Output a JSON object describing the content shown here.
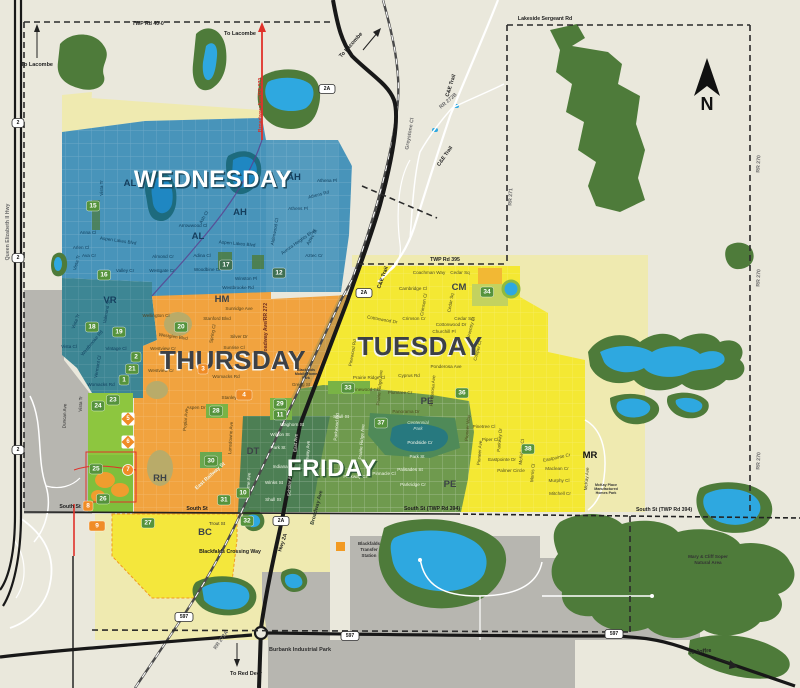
{
  "days": {
    "wednesday": "WEDNESDAY",
    "thursday": "THURSDAY",
    "tuesday": "TUESDAY",
    "friday": "FRIDAY"
  },
  "area_codes": {
    "ah1": "AH",
    "ah2": "AH",
    "al1": "AL",
    "al2": "AL",
    "vr": "VR",
    "hm": "HM",
    "dt": "DT",
    "rh": "RH",
    "bc": "BC",
    "pe1": "PE",
    "pe2": "PE",
    "cm": "CM",
    "mr": "MR"
  },
  "badges": {
    "b1": "1",
    "b2": "2",
    "b3": "3",
    "b4": "4",
    "b5": "5",
    "b6": "6",
    "b7": "7",
    "b8": "8",
    "b9": "9",
    "b10": "10",
    "b11": "11",
    "b12": "12",
    "b15": "15",
    "b16": "16",
    "b17": "17",
    "b18": "18",
    "b19": "19",
    "b20": "20",
    "b21": "21",
    "b23": "23",
    "b24": "24",
    "b25": "25",
    "b26": "26",
    "b27": "27",
    "b28": "28",
    "b29": "29",
    "b30": "30",
    "b31": "31",
    "b32": "32",
    "b33": "33",
    "b34": "34",
    "b36": "36",
    "b37": "37",
    "b38": "38"
  },
  "shields": {
    "s2": "2",
    "s2a": "2A",
    "s597": "597"
  },
  "compass": {
    "n": "N"
  },
  "directions": {
    "lacombe": "To Lacombe",
    "reddeer": "To Red Deer",
    "joffre": "To Joffre"
  },
  "roads": {
    "twp400": "TWP Rd 40-0",
    "lakeside": "Lakeside Sergeant Rd",
    "twp395": "TWP Rd 395",
    "qe2": "Queen Elizabeth II Hwy",
    "ce": "C&E Trail",
    "rr272b": "RR 272B",
    "greystone": "Greystone Cl",
    "rr271": "RR 271",
    "rr270": "RR 270",
    "south": "South St",
    "south394": "South St (TWP Rd 394)",
    "hwy2a": "Hwy 2A",
    "rr272a": "RR 272A",
    "crossing": "Blackfalds Crossing Way",
    "east_rail": "East Railway St",
    "broadway": "Broadway Ave/RR 272",
    "broadway_s": "Broadway Ave"
  },
  "places": {
    "transfer_l1": "Blackfalds",
    "transfer_l2": "Transfer",
    "transfer_l3": "Station",
    "burbank": "Burbank Industrial Park",
    "soper_l1": "Mary & Cliff Soper",
    "soper_l2": "Natural Area",
    "centennial_l1": "Centennial",
    "centennial_l2": "Park",
    "mckay_l1": "McKay Place",
    "mckay_l2": "Manufactured",
    "mckay_l3": "Homes Park",
    "mobile_l1": "Blackfalds",
    "mobile_l2": "Mobile Home",
    "mobile_l3": "Park"
  },
  "streets": {
    "w1": "Vista Tr",
    "w2": "Anna Cl",
    "w3": "Aspen Lakes Blvd",
    "w4": "Aspen Lakes Blvd",
    "w5": "Arlen Cl",
    "w6": "Ava Cr",
    "w7": "Valley Cr",
    "w8": "Almond Cr",
    "w9": "Westgate Cr",
    "w10": "Adina Cl",
    "w11": "Woodbine Cl",
    "w12": "Arrowwood Cl",
    "w13": "Ash Cl",
    "w14": "Athena Pl",
    "w15": "Athens Rd",
    "w16": "Athens Pl",
    "w17": "Alderwood Cl",
    "w18": "Aurora Heights Blvd",
    "w19": "Aztec St",
    "w20": "Aztec Cr",
    "w21": "Winston Pl",
    "w22": "Westbrooke Rd",
    "w23": "Vista Tr",
    "v1": "Valmond St",
    "v2": "Vista Tr",
    "v3": "Westbrooke Rd",
    "v4": "Vista Cl",
    "v5": "Vintage Cl",
    "v6": "Vermont Cl",
    "v7": "Womacks Rd",
    "t1": "Wellington Cl",
    "t2": "Sunridge Ave",
    "t3": "Stanford Blvd",
    "t4": "Westglen Blvd",
    "t5": "Silver Dr",
    "t6": "Sunrise Cl",
    "t7": "Spring Cl",
    "t8": "Westview Cr",
    "t9": "Westview Cr",
    "t10": "Womacks Rd",
    "t11": "Gregg St",
    "t12": "Stanley St",
    "t13": "Aspen Dr",
    "t14": "Poplar Ave",
    "t15": "Lansdowne Ave",
    "y1": "Coachman Way",
    "y2": "Cedar Sq",
    "y3": "Cambridge Cl",
    "y4": "Crimson Cl",
    "y5": "Cedar Sq",
    "y6": "Crimson Cr",
    "y7": "Cedar Sq",
    "y8": "Cottonwood Dr",
    "y9": "Cottonwood Dr",
    "y10": "Churchill Pl",
    "y11": "Coventry Cl",
    "y12": "Cooper Cl",
    "y13": "Cyprus Rd",
    "y14": "Ponderosa Ave",
    "y15": "Ponderosa Ave",
    "y16": "Plumtree Cr",
    "y17": "Prairie Ridge Ave",
    "y18": "Prairie Ridge Cl",
    "y19": "Pinewood Cl",
    "y20": "Pinewood Rd",
    "e1": "Panorama Dr",
    "e2": "Pioneer Way",
    "e3": "Pinetree Cl",
    "e4": "Piper Cl",
    "e5": "Parkway Dr",
    "e6": "Pioneer Ave",
    "e7": "Eastpointe Dr",
    "e8": "Eastpointe Cr",
    "e9": "Palmer Circle",
    "e10": "Morris Cl",
    "e11": "Maclean Cr",
    "e12": "Murphy Cl",
    "e13": "Mitchell Cr",
    "e14": "McKay Ave",
    "e15": "McKelvey Cl",
    "f1": "Pondside Cr",
    "f2": "Park St",
    "f3": "Palisades St",
    "f4": "Parkridge Cr",
    "f5": "Pinnacle Cl",
    "f6": "Parkway Cl",
    "f7": "Parkwood Rd",
    "f8": "Prairie Ridge Ave",
    "d1": "Waghorn St",
    "d2": "Wilson St",
    "d3": "Park St",
    "d4": "Indiana St",
    "d5": "Winks St",
    "d6": "Shull St",
    "d7": "East Ave",
    "d8": "Highway Ave",
    "d9": "Scholar Ave",
    "d10": "Lorne Ave",
    "d11": "Shull St",
    "c1": "Trout St",
    "c2": "Duncan Ave",
    "c3": "Vista Tr"
  }
}
